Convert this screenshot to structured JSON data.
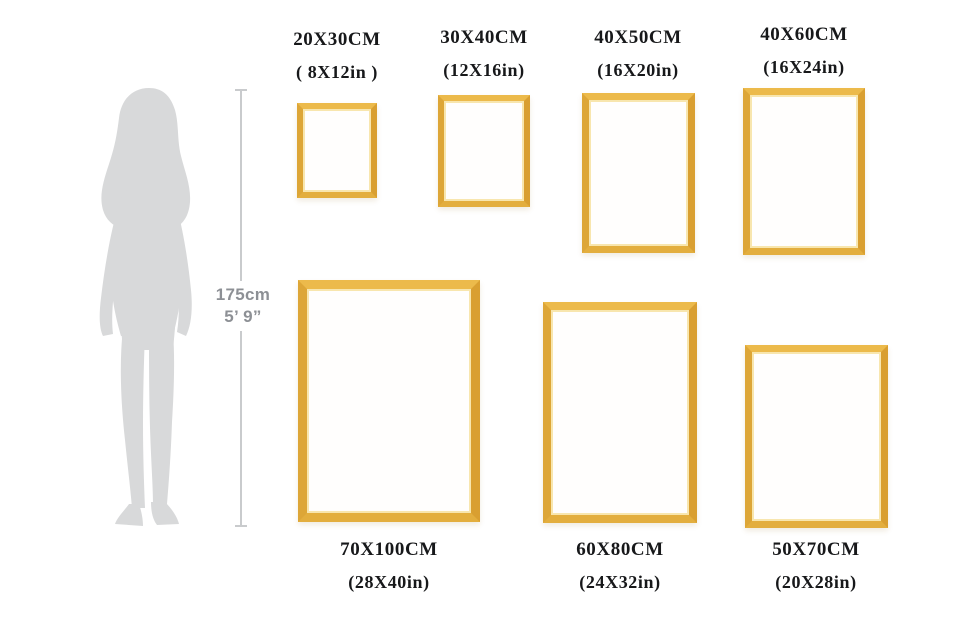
{
  "figure": {
    "type": "picture-frame-size-comparison",
    "person": {
      "height_cm": "175cm",
      "height_ft": "5’ 9”",
      "silhouette": "woman-standing-silhouette"
    },
    "frames": [
      {
        "id": "20x30",
        "cm": "20X30CM",
        "inch": "( 8X12in )"
      },
      {
        "id": "30x40",
        "cm": "30X40CM",
        "inch": "(12X16in)"
      },
      {
        "id": "40x50",
        "cm": "40X50CM",
        "inch": "(16X20in)"
      },
      {
        "id": "40x60",
        "cm": "40X60CM",
        "inch": "(16X24in)"
      },
      {
        "id": "70x100",
        "cm": "70X100CM",
        "inch": "(28X40in)"
      },
      {
        "id": "60x80",
        "cm": "60X80CM",
        "inch": "(24X32in)"
      },
      {
        "id": "50x70",
        "cm": "50X70CM",
        "inch": "(20X28in)"
      }
    ],
    "colors": {
      "frame_gold": "#e3ae3e",
      "frame_gold_dark": "#d99f31",
      "frame_gold_light": "#f8e6ae",
      "silhouette_gray": "#d8d9da",
      "measure_line": "#c9cbcd",
      "measure_text": "#8d9095",
      "label_text": "#17181a",
      "background": "#ffffff"
    }
  }
}
